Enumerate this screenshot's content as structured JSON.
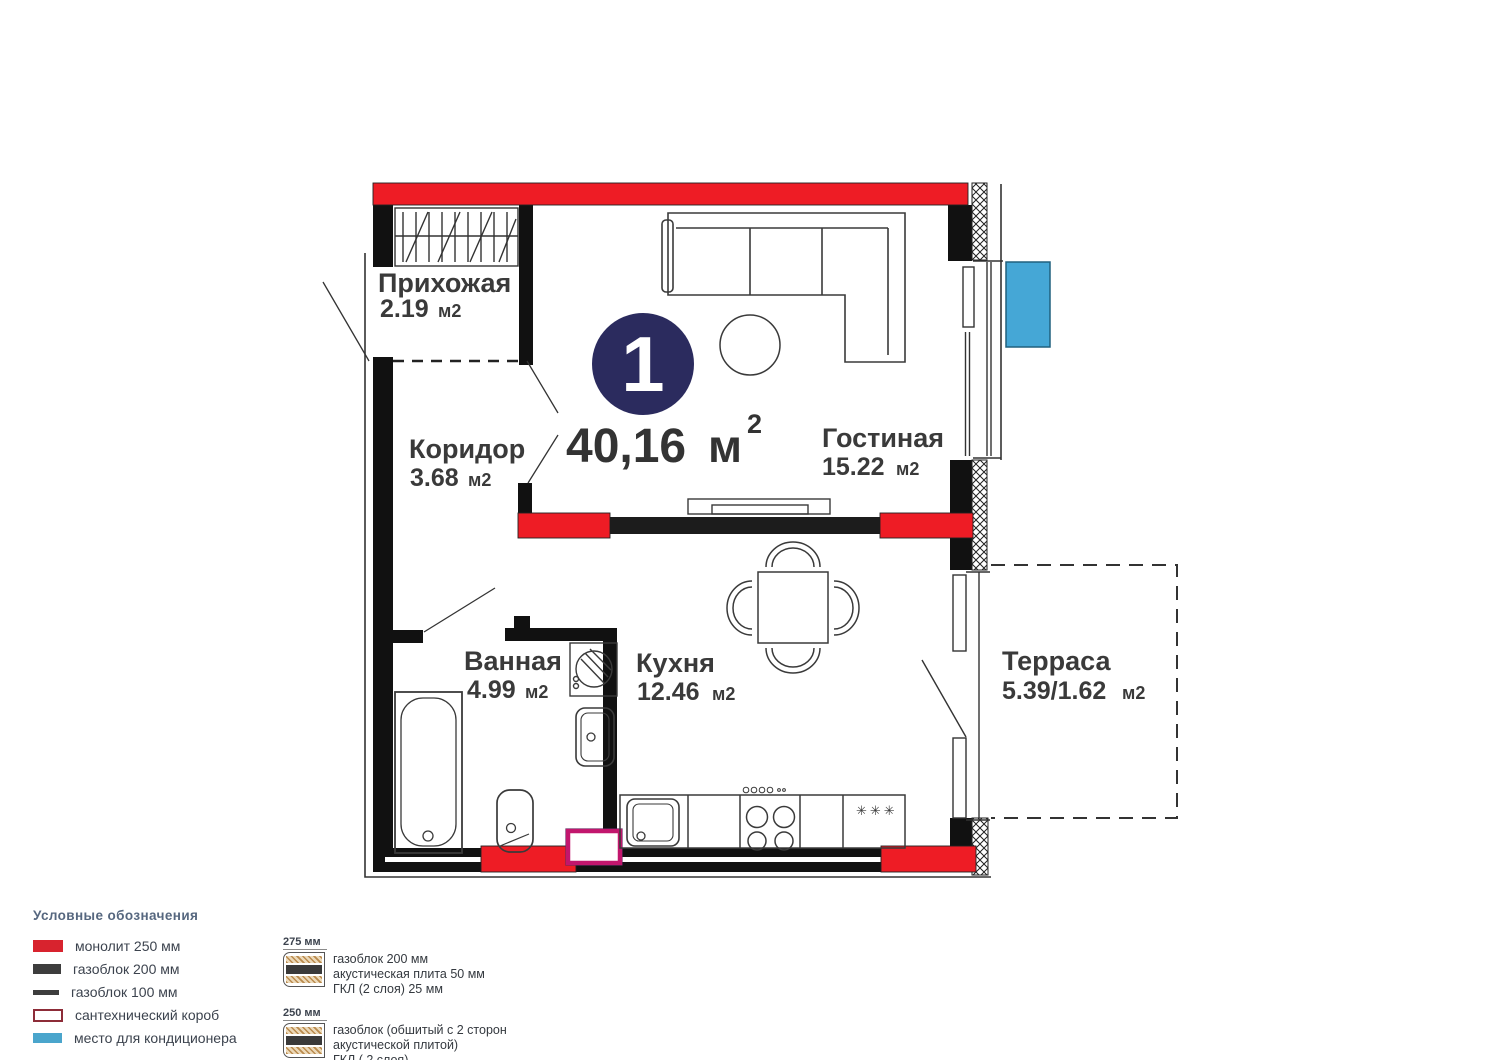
{
  "plan": {
    "badge_number": "1",
    "total_area": {
      "value": "40,16",
      "unit": "м",
      "sup": "2"
    },
    "rooms": [
      {
        "name": "Прихожая",
        "area": "2.19",
        "unit": "м2"
      },
      {
        "name": "Коридор",
        "area": "3.68",
        "unit": "м2"
      },
      {
        "name": "Гостиная",
        "area": "15.22",
        "unit": "м2"
      },
      {
        "name": "Ванная",
        "area": "4.99",
        "unit": "м2"
      },
      {
        "name": "Кухня",
        "area": "12.46",
        "unit": "м2"
      },
      {
        "name": "Терраса",
        "area": "5.39/1.62",
        "unit": "м2"
      }
    ],
    "fridge_stars": "✳✳✳"
  },
  "legend": {
    "title": "Условные обозначения",
    "items": [
      {
        "label": "монолит 250 мм",
        "swatch": "red-solid"
      },
      {
        "label": "газоблок 200 мм",
        "swatch": "dark-solid"
      },
      {
        "label": "газоблок 100 мм",
        "swatch": "dark-thin"
      },
      {
        "label": "сантехнический короб",
        "swatch": "maroon-outline"
      },
      {
        "label": "место для кондиционера",
        "swatch": "blue-solid"
      }
    ],
    "wall_types": [
      {
        "size": "275 мм",
        "lines": [
          "газоблок 200 мм",
          "акустическая плита 50 мм",
          "ГКЛ (2 слоя) 25 мм"
        ]
      },
      {
        "size": "250 мм",
        "lines": [
          "газоблок (обшитый с 2 сторон",
          "акустической плитой)",
          "ГКЛ ( 2 слоя)"
        ]
      }
    ]
  },
  "colors": {
    "wall_red": "#ee1c25",
    "badge_navy": "#2b2b5e",
    "ac_blue": "#45a7d6",
    "plumbing_box_magenta": "#c2166d",
    "legend_red": "#d8232e",
    "legend_dark": "#3d3d3d",
    "legend_korob_border": "#8d2c38",
    "legend_blue": "#4aa5cc",
    "legend_title_blue": "#56677f"
  }
}
